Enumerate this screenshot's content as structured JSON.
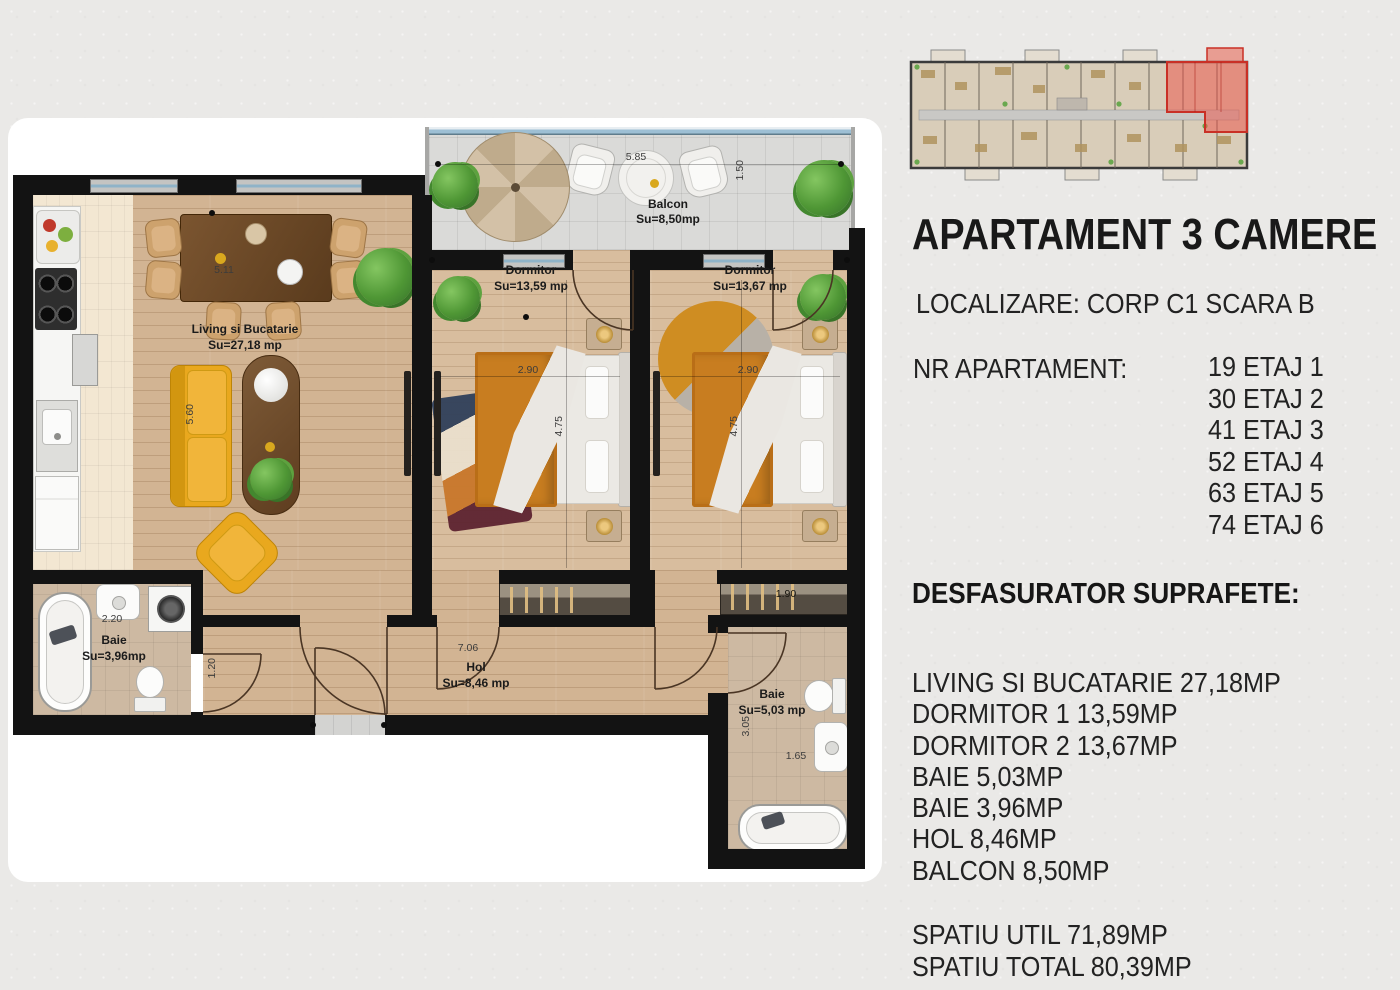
{
  "title": "APARTAMENT 3 CAMERE",
  "location_line": "LOCALIZARE: CORP C1 SCARA B",
  "apartment_numbers": {
    "label": "NR APARTAMENT:",
    "entries": [
      "19 ETAJ 1",
      "30 ETAJ 2",
      "41 ETAJ 3",
      "52 ETAJ 4",
      "63 ETAJ 5",
      "74 ETAJ 6"
    ]
  },
  "surfaces": {
    "heading": "DESFASURATOR SUPRAFETE:",
    "items": [
      "LIVING SI BUCATARIE 27,18MP",
      "DORMITOR 1 13,59MP",
      "DORMITOR 2 13,67MP",
      "BAIE 5,03MP",
      "BAIE 3,96MP",
      "HOL 8,46MP",
      "BALCON 8,50MP"
    ],
    "totals": [
      "SPATIU UTIL 71,89MP",
      "SPATIU TOTAL 80,39MP"
    ]
  },
  "plan": {
    "rooms": {
      "balcon": {
        "name": "Balcon",
        "area": "Su=8,50mp"
      },
      "living": {
        "name": "Living si Bucatarie",
        "area": "Su=27,18 mp"
      },
      "dorm1": {
        "name": "Dormitor",
        "area": "Su=13,59 mp"
      },
      "dorm2": {
        "name": "Dormitor",
        "area": "Su=13,67 mp"
      },
      "baie1": {
        "name": "Baie",
        "area": "Su=3,96mp"
      },
      "baie2": {
        "name": "Baie",
        "area": "Su=5,03 mp"
      },
      "hol": {
        "name": "Hol",
        "area": "Su=8,46 mp"
      }
    },
    "dims": {
      "balcon_w": "5.85",
      "balcon_d": "1.50",
      "living_w": "5.11",
      "sofa_l": "5.60",
      "dorm_w": "2.90",
      "dorm_d": "4.75",
      "baie1_w": "2.20",
      "baie1_door": "1.20",
      "hol_w": "7.06",
      "wardrobe_w": "1.90",
      "baie2_d": "3.05",
      "baie2_w": "1.65"
    }
  },
  "colors": {
    "highlight_red": "#c93026",
    "sofa_yellow": "#e9a81e",
    "wall_black": "#131313"
  }
}
